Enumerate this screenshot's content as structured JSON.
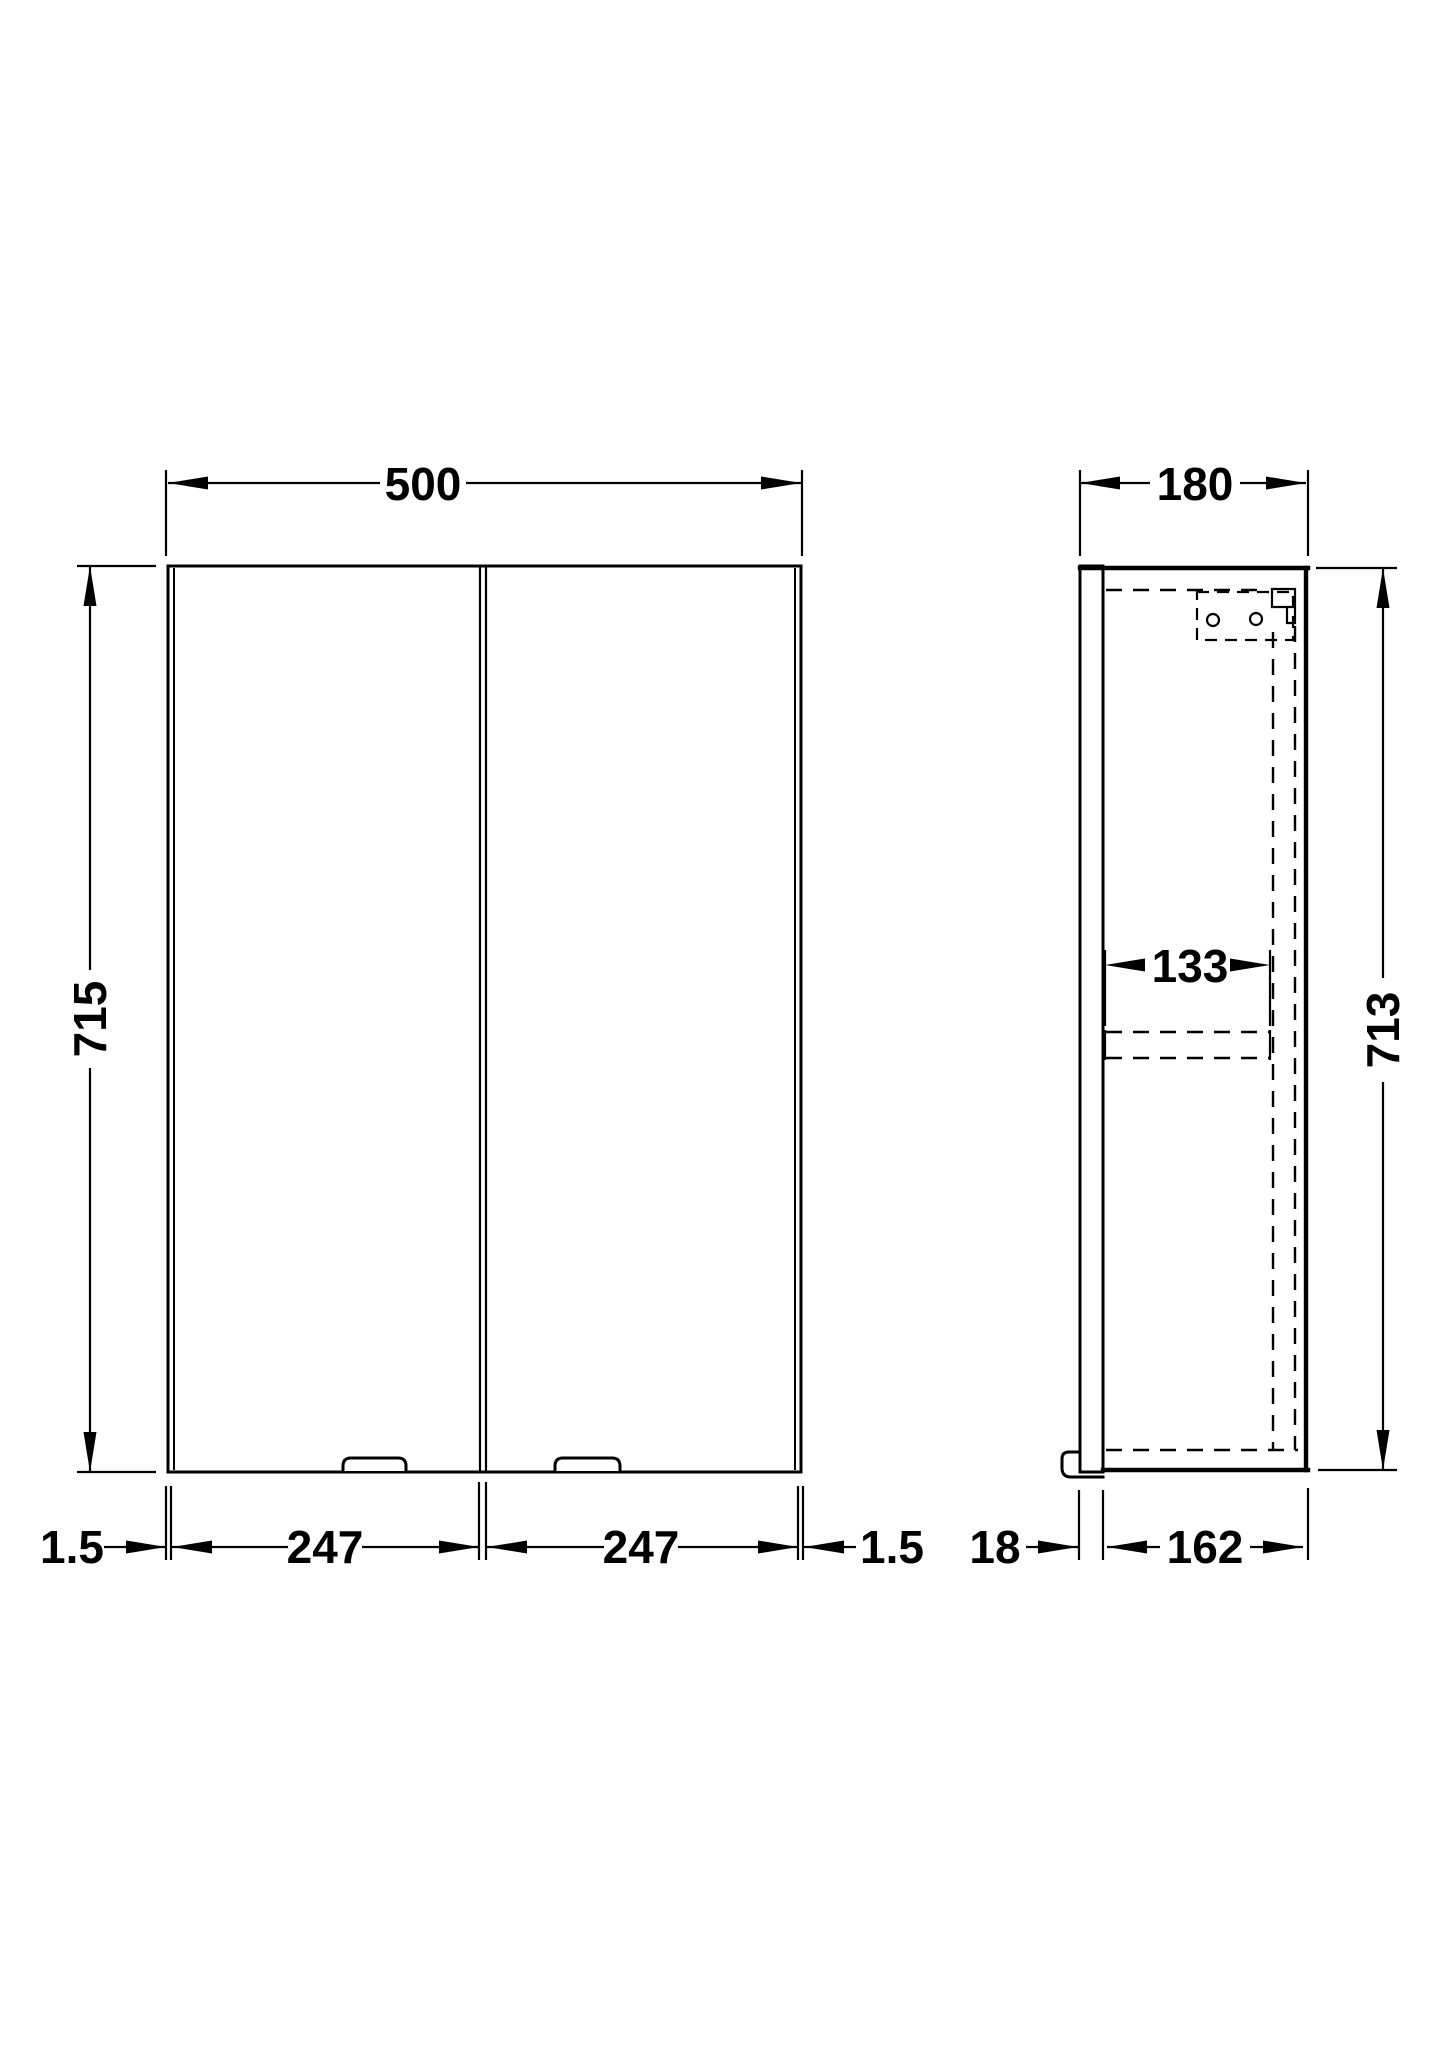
{
  "front_view": {
    "width": "500",
    "height": "715",
    "left_gap": "1.5",
    "left_door_width": "247",
    "right_door_width": "247",
    "right_gap": "1.5"
  },
  "side_view": {
    "depth": "180",
    "height": "713",
    "internal_depth": "133",
    "door_thickness": "18",
    "carcass_depth": "162"
  },
  "colors": {
    "line": "#000000",
    "background": "#ffffff"
  }
}
